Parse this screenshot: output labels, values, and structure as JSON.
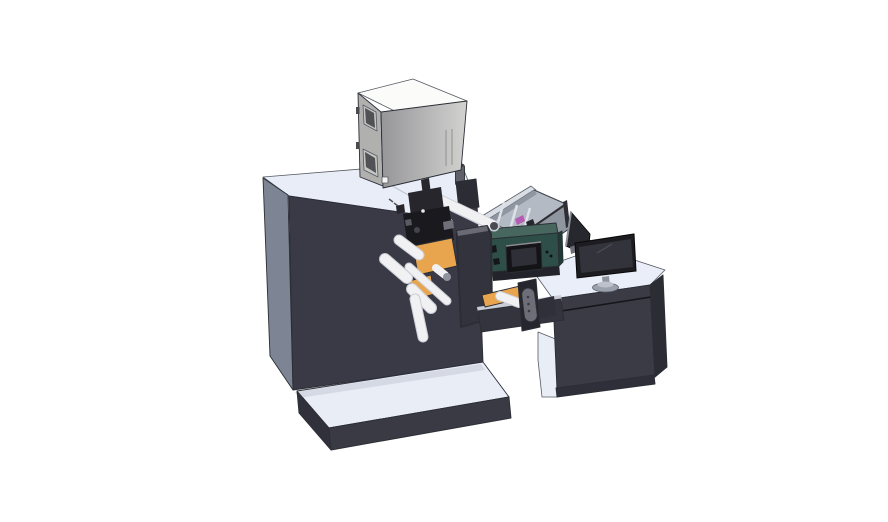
{
  "scene": {
    "type": "3d-cad-render",
    "view": "isometric",
    "description": "CAD rendering of a roll-fed label printing machine with top cabinet, web rollers, HMI control box, infeed tray and operator desk with monitor",
    "background": "#ffffff"
  },
  "parts": [
    {
      "id": "machine-body",
      "label": "main machine cabinet"
    },
    {
      "id": "top-cabinet",
      "label": "gray electronics cabinet on top"
    },
    {
      "id": "exhaust-cylinder",
      "label": "small cylinder on machine top"
    },
    {
      "id": "print-head",
      "label": "black print head mechanism"
    },
    {
      "id": "web-rollers",
      "label": "white web guide rollers"
    },
    {
      "id": "orange-plates",
      "label": "orange unwind plates"
    },
    {
      "id": "front-guard-plate",
      "label": "dark guard plate"
    },
    {
      "id": "infeed-tray",
      "label": "open-top infeed tray"
    },
    {
      "id": "hmi-control-box",
      "label": "teal HMI control box with screen"
    },
    {
      "id": "transfer-beam",
      "label": "transfer bridge beam"
    },
    {
      "id": "sensor-pill",
      "label": "gray sensor handle"
    },
    {
      "id": "operator-desk",
      "label": "operator desk cabinet"
    },
    {
      "id": "desk-monitor",
      "label": "desktop monitor"
    },
    {
      "id": "monitor-side-panel",
      "label": "second panel seen edge-on"
    },
    {
      "id": "base-platform-left",
      "label": "machine base platform"
    },
    {
      "id": "base-platform-right",
      "label": "desk base platform"
    }
  ],
  "colors": {
    "background": "#ffffff",
    "machine_top": "#e9edf7",
    "machine_left": "#7d8494",
    "machine_front": "#3a3a46",
    "seam": "#b9bdc6",
    "tick": "#55555c",
    "platform_top": "#e9edf6",
    "platform_front": "#3a3a45",
    "platform_side": "#31313b",
    "platform_shadow": "#d4d9e4",
    "box_top": "#fbfbf9",
    "box_left": "#b0b0ae",
    "box_front_dark": "#96969a",
    "box_front_light": "#d2d2d0",
    "box_window_frame": "#c6c6c4",
    "box_window_glass": "#515156",
    "box_detail": "#4a4a4e",
    "box_slot": "#9a9a98",
    "box_square": "#f4f4f2",
    "cylinder": "#60606a",
    "cylinder_cap": "#3f3f44",
    "mount_plate": "#2c2c34",
    "head_dark": "#1a1a1e",
    "head_mid": "#26262c",
    "head_gray": "#70707a",
    "head_gray2": "#5a5a62",
    "head_hub": "#44444c",
    "head_dot": "#e8e8ea",
    "roller": "#f1f1f3",
    "roller_shade": "#c9ccd4",
    "roller_cap": "#8f949c",
    "roller_cap_dark": "#4a4a52",
    "orange": "#e9a54e",
    "front_plate": "#33333d",
    "front_plate_top": "#6a6a74",
    "tray_rim": "#d9dde4",
    "tray_interior": "#b3bac3",
    "tray_wall": "#9096a0",
    "tray_divider": "#dde1e8",
    "tray_trim": "#2e2e34",
    "tray_backrim": "#484850",
    "magenta": "#b55cb5",
    "teal_top": "#46665e",
    "teal_front": "#2e4f48",
    "teal_side": "#1f3b35",
    "screen_bezel": "#141417",
    "screen_face": "#2f2f37",
    "screen_highlight": "#8a8a90",
    "button_dark": "#121216",
    "connector_dark": "#15161a",
    "shadow_dark": "#23232b",
    "beam": "#34343f",
    "beam_top": "#c9cdd6",
    "bracket": "#26262e",
    "connector_block": "#30303a",
    "pill": "#6e6e78",
    "pill_dot": "#3a3a42",
    "desk_top": "#eaeef8",
    "desk_front": "#3b3b46",
    "desk_side": "#2c2c35",
    "desk_plinth": "#2f2f39",
    "desk_seam": "#14141a",
    "panel_dark": "#27272e",
    "panel_edge": "#8b919b",
    "monitor_bezel": "#1c1c21",
    "monitor_screen": "#33333b",
    "monitor_reflection": "#4d4d55",
    "monitor_stand": "#8e949e",
    "monitor_base": "#9aa1ac",
    "monitor_base_top": "#bcc1ca"
  }
}
